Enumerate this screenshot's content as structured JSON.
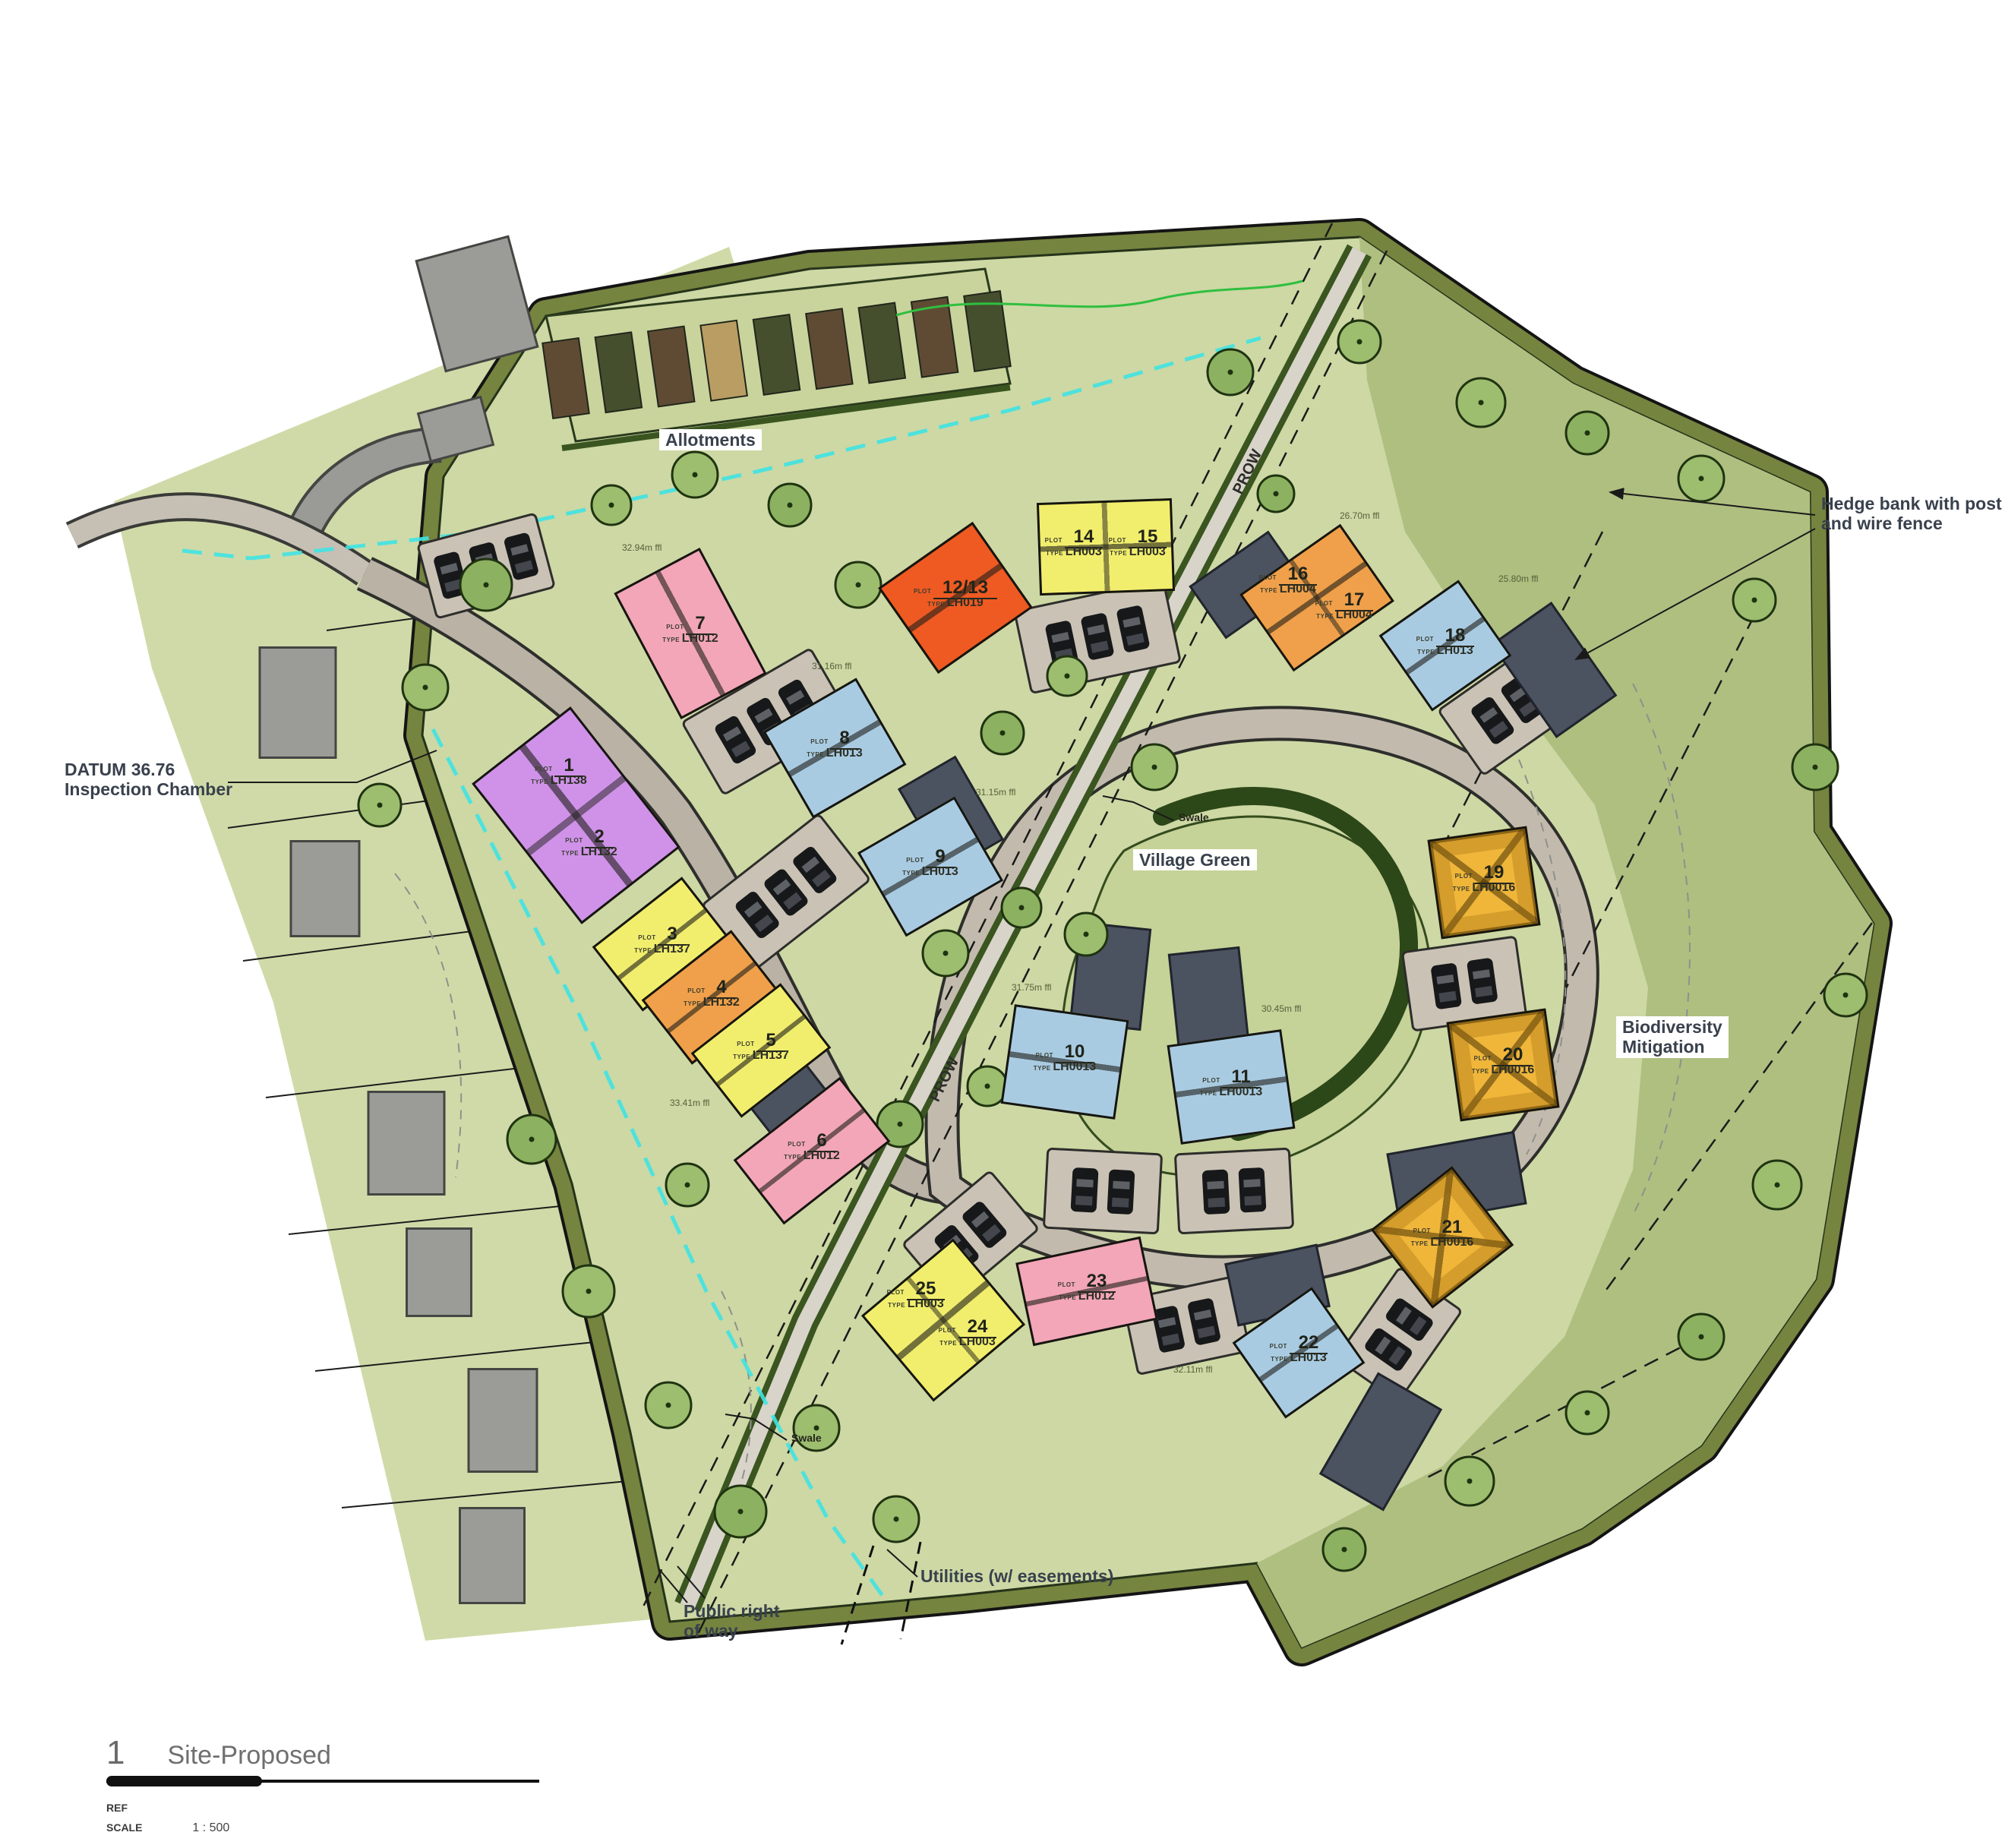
{
  "title_block": {
    "figure_number": "1",
    "title": "Site-Proposed",
    "ref_label": "REF",
    "scale_label": "SCALE",
    "scale_value": "1 : 500"
  },
  "annotations": {
    "allotments": "Allotments",
    "hedge_bank_1": "Hedge bank with post",
    "hedge_bank_2": "and wire fence",
    "datum_1": "DATUM 36.76",
    "datum_2": "Inspection Chamber",
    "village_green": "Village Green",
    "biodiversity_1": "Biodiversity",
    "biodiversity_2": "Mitigation",
    "utilities": "Utilities (w/ easements)",
    "public_row_1": "Public right",
    "public_row_2": "of way",
    "swale": "Swale",
    "prow": "PROW"
  },
  "prefixes": {
    "plot": "PLOT",
    "type": "TYPE"
  },
  "colors": {
    "site_green": "#cdd8a4",
    "hedge_band": "#75843f",
    "biodiversity_green": "#aebf80",
    "road_grey": "#b9b2a5",
    "utility_cyan": "#3fe3e3",
    "yellow": "#f2ee6d",
    "orange": "#f0a04a",
    "red_orange": "#ee5a22",
    "pink": "#f3a6b8",
    "purple": "#cf92e8",
    "blue": "#a9cbe2",
    "gold": "#f0b63a"
  },
  "plots": [
    {
      "number": "1",
      "type": "LH138",
      "color": "#cf92e8"
    },
    {
      "number": "2",
      "type": "LH132",
      "color": "#cf92e8"
    },
    {
      "number": "3",
      "type": "LH137",
      "color": "#f2ee6d"
    },
    {
      "number": "4",
      "type": "LH132",
      "color": "#f0a04a"
    },
    {
      "number": "5",
      "type": "LH137",
      "color": "#f2ee6d",
      "ffl": "33.41m ffl"
    },
    {
      "number": "6",
      "type": "LH012",
      "color": "#f3a6b8"
    },
    {
      "number": "7",
      "type": "LH012",
      "color": "#f3a6b8",
      "ffl": "32.94m ffl"
    },
    {
      "number": "8",
      "type": "LH013",
      "color": "#a9cbe2",
      "ffl": "31.16m ffl"
    },
    {
      "number": "9",
      "type": "LH013",
      "color": "#a9cbe2",
      "ffl": "31.15m ffl"
    },
    {
      "number": "10",
      "type": "LH0013",
      "color": "#a9cbe2",
      "ffl": "31.75m ffl"
    },
    {
      "number": "11",
      "type": "LH0013",
      "color": "#a9cbe2",
      "ffl": "30.45m ffl"
    },
    {
      "number": "12/13",
      "type": "LH019",
      "color": "#ee5a22"
    },
    {
      "number": "14",
      "type": "LH003",
      "color": "#f2ee6d"
    },
    {
      "number": "15",
      "type": "LH003",
      "color": "#f2ee6d"
    },
    {
      "number": "16",
      "type": "LH004",
      "color": "#f0a04a",
      "ffl": "26.70m ffl"
    },
    {
      "number": "17",
      "type": "LH004",
      "color": "#f0a04a"
    },
    {
      "number": "18",
      "type": "LH013",
      "color": "#a9cbe2",
      "ffl": "25.80m ffl"
    },
    {
      "number": "19",
      "type": "LH0016",
      "color": "#f0b63a"
    },
    {
      "number": "20",
      "type": "LH0016",
      "color": "#f0b63a"
    },
    {
      "number": "21",
      "type": "LH0016",
      "color": "#f0b63a"
    },
    {
      "number": "22",
      "type": "LH013",
      "color": "#a9cbe2",
      "ffl": "32.11m ffl"
    },
    {
      "number": "23",
      "type": "LH012",
      "color": "#f3a6b8"
    },
    {
      "number": "24",
      "type": "LH003",
      "color": "#f2ee6d"
    },
    {
      "number": "25",
      "type": "LH003",
      "color": "#f2ee6d"
    }
  ]
}
